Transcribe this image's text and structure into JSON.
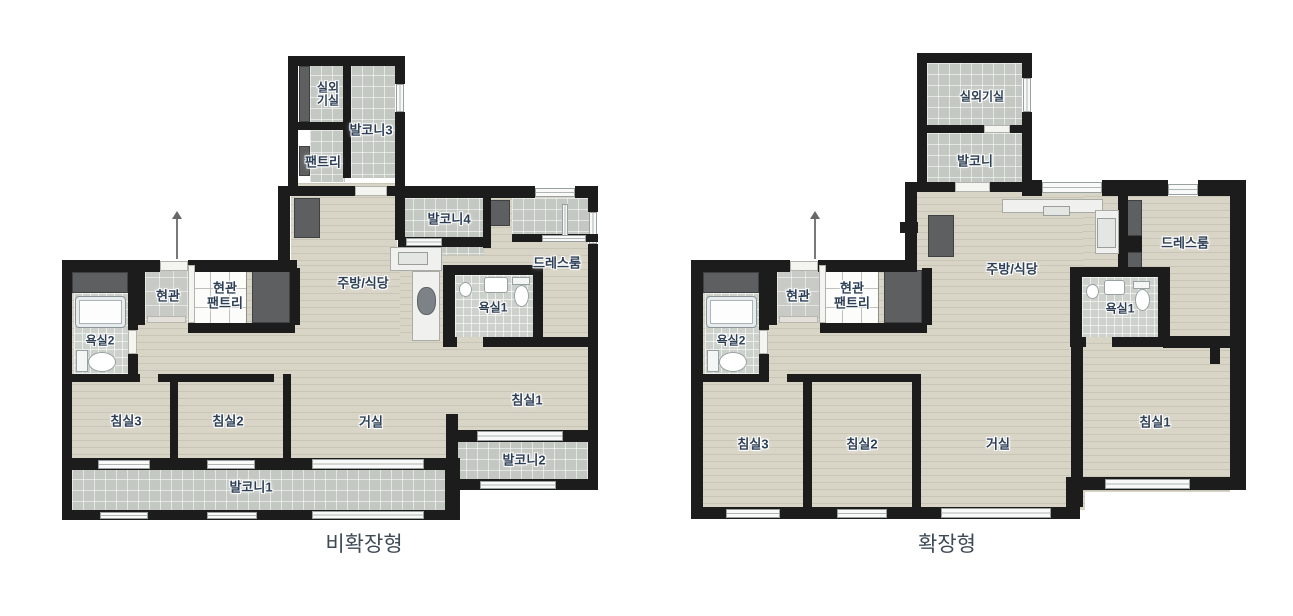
{
  "palette": {
    "wall": "#1c1c1c",
    "wood_floor": "#d8d4c6",
    "balcony_tile": "#c4c8c2",
    "bath_tile": "#cdd1cb",
    "entry_tile": "#c8cac5",
    "closet": "#5d5f61",
    "label_text": "#2c3f55",
    "caption_text": "#3e4a57",
    "background": "#ffffff"
  },
  "plans": [
    {
      "id": "non-expanded",
      "caption": "비확장형",
      "labels": {
        "outdoor_unit_l1": "실외",
        "outdoor_unit_l2": "기실",
        "balcony3": "발코니3",
        "pantry": "팬트리",
        "balcony4": "발코니4",
        "dressroom": "드레스룸",
        "kitchen": "주방/식당",
        "entrance": "현관",
        "entrance_pantry_l1": "현관",
        "entrance_pantry_l2": "팬트리",
        "bath1": "욕실1",
        "bath2": "욕실2",
        "bed3": "침실3",
        "bed2": "침실2",
        "living": "거실",
        "bed1": "침실1",
        "balcony2": "발코니2",
        "balcony1": "발코니1"
      }
    },
    {
      "id": "expanded",
      "caption": "확장형",
      "labels": {
        "outdoor_unit": "실외기실",
        "balcony": "발코니",
        "dressroom": "드레스룸",
        "kitchen": "주방/식당",
        "entrance": "현관",
        "entrance_pantry_l1": "현관",
        "entrance_pantry_l2": "팬트리",
        "bath1": "욕실1",
        "bath2": "욕실2",
        "bed3": "침실3",
        "bed2": "침실2",
        "living": "거실",
        "bed1": "침실1"
      }
    }
  ]
}
